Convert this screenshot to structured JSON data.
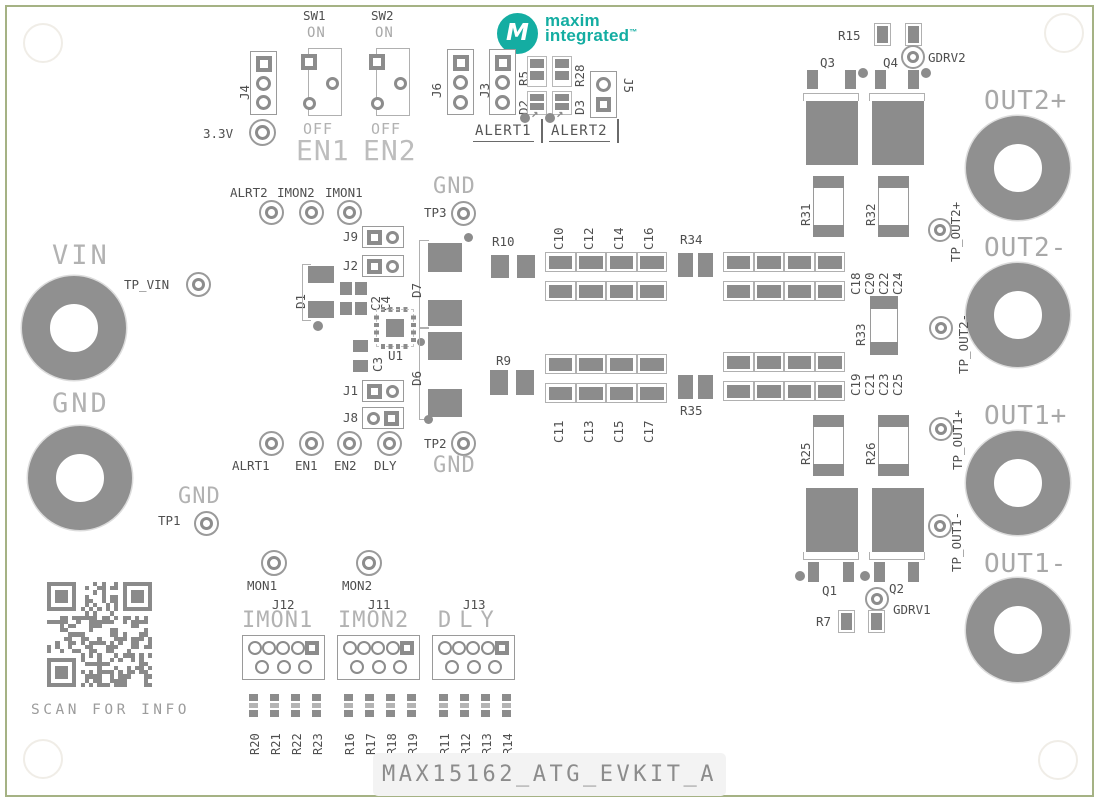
{
  "board": {
    "title": "MAX15162_ATG_EVKIT_A",
    "qr_caption": "SCAN FOR INFO"
  },
  "logo": {
    "line1": "maxim",
    "line2": "integrated",
    "tm": "™",
    "monogram": "M"
  },
  "colors": {
    "brand_teal": "#14ada2",
    "pad_gray": "#8c8c8c",
    "outline_gray": "#b0b0b0",
    "dark_text": "#4f4f4f",
    "light_text": "#b2b2b2",
    "board_edge_green": "#a5b284"
  },
  "top": {
    "j4": "J4",
    "v33": "3.3V",
    "sw1": "SW1",
    "sw2": "SW2",
    "on": "ON",
    "off": "OFF",
    "en1": "EN1",
    "en2": "EN2",
    "j6": "J6",
    "j3": "J3",
    "r5": "R5",
    "d2": "D2",
    "r28": "R28",
    "d3": "D3",
    "j5": "J5",
    "alert1": "ALERT1",
    "alert2": "ALERT2"
  },
  "left": {
    "vin": "VIN",
    "tp_vin": "TP_VIN",
    "gnd": "GND",
    "tp1": "TP1",
    "tp1_net": "GND"
  },
  "mid": {
    "alrt2": "ALRT2",
    "imon2": "IMON2",
    "imon1": "IMON1",
    "tp3": "TP3",
    "tp3_net": "GND",
    "j9": "J9",
    "j2": "J2",
    "d1": "D1",
    "c2": "C2",
    "c4": "C4",
    "u1": "U1",
    "c3": "C3",
    "j1": "J1",
    "j8": "J8",
    "alrt1": "ALRT1",
    "en1": "EN1",
    "en2": "EN2",
    "dly": "DLY",
    "tp2": "TP2",
    "tp2_net": "GND",
    "d7": "D7",
    "r10": "R10",
    "d6": "D6",
    "r9": "R9"
  },
  "caps": {
    "tl": [
      "C10",
      "C12",
      "C14",
      "C16"
    ],
    "bl": [
      "C11",
      "C13",
      "C15",
      "C17"
    ],
    "tr": [
      "C18",
      "C20",
      "C22",
      "C24"
    ],
    "br": [
      "C19",
      "C21",
      "C23",
      "C25"
    ],
    "r34": "R34",
    "r35": "R35",
    "r33": "R33"
  },
  "right": {
    "r15": "R15",
    "q3": "Q3",
    "q4": "Q4",
    "gdrv2": "GDRV2",
    "r31": "R31",
    "r32": "R32",
    "out2p": "OUT2+",
    "tp_out2p": "TP_OUT2+",
    "out2m": "OUT2-",
    "tp_out2m": "TP_OUT2-",
    "tp_out1p": "TP_OUT1+",
    "out1p": "OUT1+",
    "tp_out1m": "TP_OUT1-",
    "out1m": "OUT1-",
    "r25": "R25",
    "r26": "R26",
    "q1": "Q1",
    "q2": "Q2",
    "gdrv1": "GDRV1",
    "r7": "R7"
  },
  "bottom": {
    "mon1": "MON1",
    "mon2": "MON2",
    "j12": "J12",
    "j12_net": "IMON1",
    "j11": "J11",
    "j11_net": "IMON2",
    "j13": "J13",
    "j13_net": "DLY",
    "rg1": [
      "R20",
      "R21",
      "R22",
      "R23"
    ],
    "rg2": [
      "R16",
      "R17",
      "R18",
      "R19"
    ],
    "rg3": [
      "R11",
      "R12",
      "R13",
      "R14"
    ]
  }
}
